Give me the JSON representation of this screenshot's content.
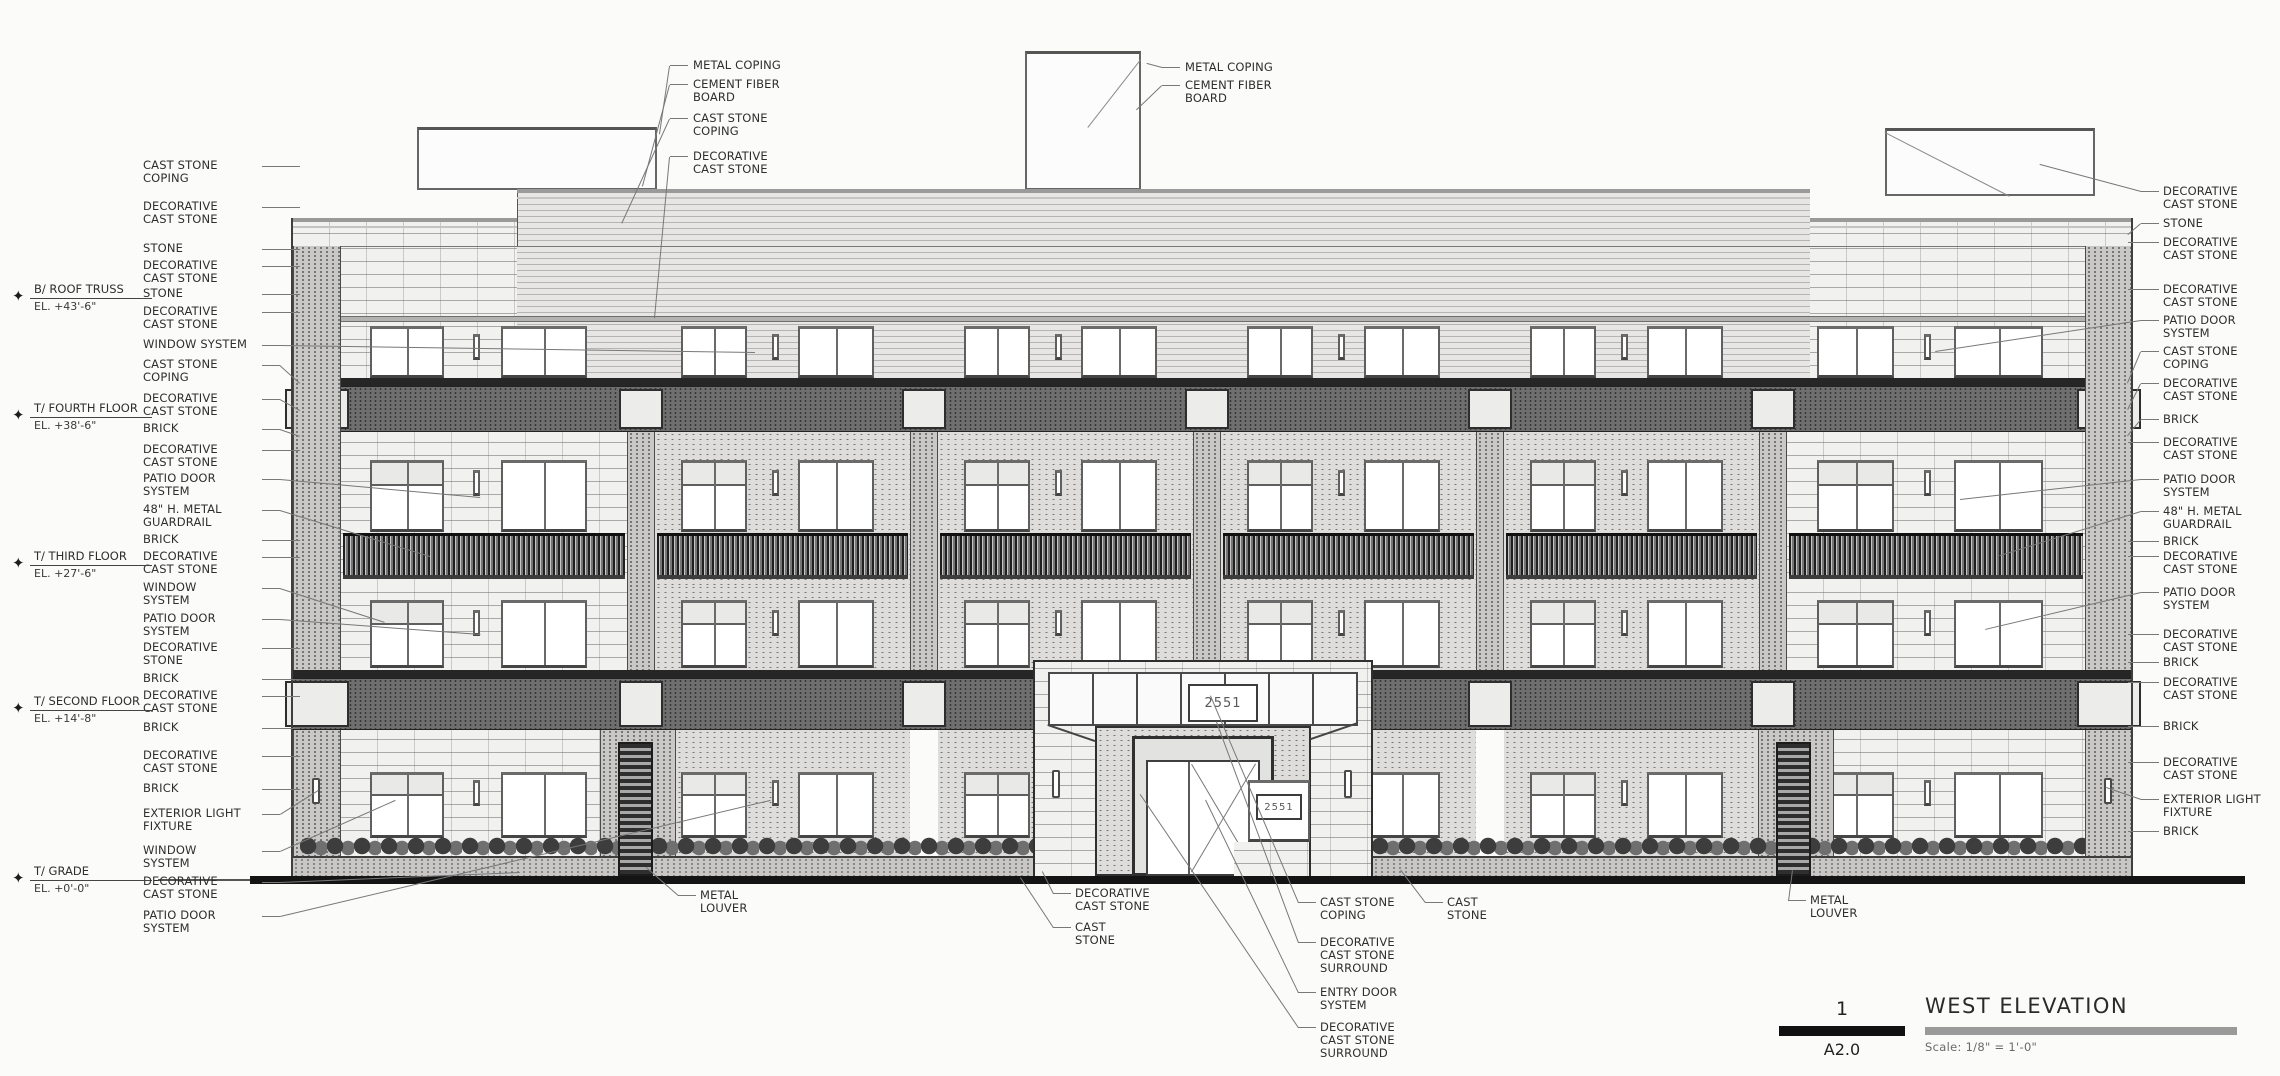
{
  "drawing": {
    "title_block": {
      "detail_number": "1",
      "sheet_number": "A2.0",
      "title": "WEST ELEVATION",
      "scale": "Scale: 1/8\" = 1'-0\""
    },
    "signs": {
      "address_plaque": "2551",
      "window_sign": "2551"
    },
    "elevation_markers": [
      {
        "y": 298,
        "name": "B/ ROOF TRUSS",
        "elevation": "EL. +43'-6\""
      },
      {
        "y": 417,
        "name": "T/ FOURTH FLOOR",
        "elevation": "EL. +38'-6\""
      },
      {
        "y": 565,
        "name": "T/ THIRD FLOOR",
        "elevation": "EL. +27'-6\""
      },
      {
        "y": 710,
        "name": "T/ SECOND FLOOR",
        "elevation": "EL. +14'-8\""
      },
      {
        "y": 880,
        "name": "T/ GRADE",
        "elevation": "EL. +0'-0\""
      }
    ],
    "callouts": {
      "left": [
        {
          "y": 166,
          "text": "CAST STONE\nCOPING"
        },
        {
          "y": 207,
          "text": "DECORATIVE\nCAST STONE"
        },
        {
          "y": 249,
          "text": "STONE"
        },
        {
          "y": 266,
          "text": "DECORATIVE\nCAST STONE"
        },
        {
          "y": 294,
          "text": "STONE"
        },
        {
          "y": 312,
          "text": "DECORATIVE\nCAST STONE"
        },
        {
          "y": 345,
          "text": "WINDOW SYSTEM",
          "tx": 755,
          "ty": 352
        },
        {
          "y": 365,
          "text": "CAST STONE\nCOPING",
          "tx": 300,
          "ty": 383
        },
        {
          "y": 399,
          "text": "DECORATIVE\nCAST STONE",
          "tx": 300,
          "ty": 410
        },
        {
          "y": 429,
          "text": "BRICK",
          "tx": 300,
          "ty": 436
        },
        {
          "y": 450,
          "text": "DECORATIVE\nCAST STONE"
        },
        {
          "y": 479,
          "text": "PATIO DOOR\nSYSTEM",
          "tx": 480,
          "ty": 497
        },
        {
          "y": 510,
          "text": "48\" H. METAL\nGUARDRAIL",
          "tx": 430,
          "ty": 556
        },
        {
          "y": 540,
          "text": "BRICK"
        },
        {
          "y": 557,
          "text": "DECORATIVE\nCAST STONE"
        },
        {
          "y": 588,
          "text": "WINDOW\nSYSTEM",
          "tx": 385,
          "ty": 622
        },
        {
          "y": 619,
          "text": "PATIO DOOR\nSYSTEM",
          "tx": 480,
          "ty": 634
        },
        {
          "y": 648,
          "text": "DECORATIVE\nSTONE"
        },
        {
          "y": 679,
          "text": "BRICK"
        },
        {
          "y": 696,
          "text": "DECORATIVE\nCAST STONE"
        },
        {
          "y": 728,
          "text": "BRICK"
        },
        {
          "y": 756,
          "text": "DECORATIVE\nCAST STONE"
        },
        {
          "y": 789,
          "text": "BRICK"
        },
        {
          "y": 814,
          "text": "EXTERIOR LIGHT\nFIXTURE",
          "tx": 318,
          "ty": 790
        },
        {
          "y": 851,
          "text": "WINDOW\nSYSTEM",
          "tx": 395,
          "ty": 800
        },
        {
          "y": 882,
          "text": "DECORATIVE\nCAST STONE",
          "tx": 520,
          "ty": 872
        },
        {
          "y": 916,
          "text": "PATIO DOOR\nSYSTEM",
          "tx": 770,
          "ty": 800
        }
      ],
      "right": [
        {
          "y": 192,
          "text": "DECORATIVE\nCAST STONE",
          "tx": 2040,
          "ty": 165
        },
        {
          "y": 224,
          "text": "STONE",
          "tx": 2128,
          "ty": 235
        },
        {
          "y": 243,
          "text": "DECORATIVE\nCAST STONE"
        },
        {
          "y": 290,
          "text": "DECORATIVE\nCAST STONE"
        },
        {
          "y": 321,
          "text": "PATIO DOOR\nSYSTEM",
          "tx": 1935,
          "ty": 352
        },
        {
          "y": 352,
          "text": "CAST STONE\nCOPING",
          "tx": 2128,
          "ty": 383
        },
        {
          "y": 384,
          "text": "DECORATIVE\nCAST STONE",
          "tx": 2128,
          "ty": 410
        },
        {
          "y": 420,
          "text": "BRICK",
          "tx": 2128,
          "ty": 436
        },
        {
          "y": 443,
          "text": "DECORATIVE\nCAST STONE"
        },
        {
          "y": 480,
          "text": "PATIO DOOR\nSYSTEM",
          "tx": 1960,
          "ty": 500
        },
        {
          "y": 512,
          "text": "48\" H. METAL\nGUARDRAIL",
          "tx": 2000,
          "ty": 556
        },
        {
          "y": 542,
          "text": "BRICK"
        },
        {
          "y": 557,
          "text": "DECORATIVE\nCAST STONE"
        },
        {
          "y": 593,
          "text": "PATIO DOOR\nSYSTEM",
          "tx": 1985,
          "ty": 630
        },
        {
          "y": 635,
          "text": "DECORATIVE\nCAST STONE"
        },
        {
          "y": 663,
          "text": "BRICK"
        },
        {
          "y": 683,
          "text": "DECORATIVE\nCAST STONE"
        },
        {
          "y": 727,
          "text": "BRICK"
        },
        {
          "y": 763,
          "text": "DECORATIVE\nCAST STONE"
        },
        {
          "y": 800,
          "text": "EXTERIOR LIGHT\nFIXTURE",
          "tx": 2106,
          "ty": 788
        },
        {
          "y": 832,
          "text": "BRICK"
        }
      ],
      "top_left": [
        {
          "y": 66,
          "text": "METAL COPING",
          "tx": 660,
          "ty": 134
        },
        {
          "y": 85,
          "text": "CEMENT FIBER\nBOARD",
          "tx": 643,
          "ty": 186
        },
        {
          "y": 119,
          "text": "CAST STONE\nCOPING",
          "tx": 622,
          "ty": 224
        },
        {
          "y": 157,
          "text": "DECORATIVE\nCAST STONE",
          "tx": 655,
          "ty": 318
        }
      ],
      "top_center": [
        {
          "y": 68,
          "text": "METAL COPING",
          "tx": 1147,
          "ty": 64
        },
        {
          "y": 86,
          "text": "CEMENT FIBER\nBOARD",
          "tx": 1137,
          "ty": 110
        }
      ],
      "bottom": [
        {
          "x": 700,
          "y": 896,
          "text": "METAL\nLOUVER",
          "tx": 646,
          "ty": 868
        },
        {
          "x": 1075,
          "y": 894,
          "text": "DECORATIVE\nCAST STONE",
          "tx": 1042,
          "ty": 872
        },
        {
          "x": 1075,
          "y": 928,
          "text": "CAST\nSTONE",
          "tx": 1020,
          "ty": 878
        },
        {
          "x": 1320,
          "y": 903,
          "text": "CAST STONE\nCOPING",
          "tx": 1210,
          "ty": 696
        },
        {
          "x": 1320,
          "y": 943,
          "text": "DECORATIVE\nCAST STONE\nSURROUND",
          "tx": 1216,
          "ty": 722
        },
        {
          "x": 1320,
          "y": 993,
          "text": "ENTRY DOOR\nSYSTEM",
          "tx": 1205,
          "ty": 800
        },
        {
          "x": 1320,
          "y": 1028,
          "text": "DECORATIVE\nCAST STONE\nSURROUND",
          "tx": 1140,
          "ty": 795
        },
        {
          "x": 1447,
          "y": 903,
          "text": "CAST\nSTONE",
          "tx": 1400,
          "ty": 870
        },
        {
          "x": 1810,
          "y": 901,
          "text": "METAL\nLOUVER",
          "tx": 1792,
          "ty": 870
        }
      ]
    }
  },
  "layout": {
    "building": {
      "x0": 293,
      "x1": 2133
    },
    "center_section": {
      "x0": 517,
      "x1": 1810,
      "top": 189
    },
    "wing_top": 218,
    "upper_field": {
      "y0": 246,
      "y1": 318
    },
    "deco_line": {
      "y0": 316,
      "y1": 322
    },
    "row4": {
      "y": 326,
      "h": 52
    },
    "band4": {
      "line_y0": 378,
      "line_y1": 386,
      "y0": 386,
      "y1": 432
    },
    "floor3": {
      "y0": 432,
      "y1": 585
    },
    "row3": {
      "y": 460,
      "h": 72
    },
    "guardrail": {
      "y": 533,
      "h": 46
    },
    "floor2": {
      "y0": 585,
      "y1": 670
    },
    "row2": {
      "y": 600,
      "h": 68
    },
    "band2": {
      "line_y0": 670,
      "line_y1": 678,
      "y0": 678,
      "y1": 730
    },
    "floor1": {
      "y0": 730,
      "y1": 856
    },
    "row1": {
      "y": 772,
      "h": 66
    },
    "base_band": {
      "y0": 856,
      "y1": 876
    },
    "grade": {
      "y": 876,
      "x0": 250,
      "x1": 2245,
      "h": 8
    },
    "bays": [
      [
        341,
        627
      ],
      [
        655,
        910
      ],
      [
        938,
        1193
      ],
      [
        1221,
        1476
      ],
      [
        1504,
        1759
      ],
      [
        1787,
        2085
      ]
    ],
    "piers": [
      [
        627,
        655
      ],
      [
        910,
        938
      ],
      [
        1193,
        1221
      ],
      [
        1476,
        1504
      ],
      [
        1759,
        1787
      ]
    ],
    "corners": [
      [
        293,
        341
      ],
      [
        2085,
        2133
      ]
    ],
    "stone_bays": [
      0,
      5
    ],
    "boxes": [
      [
        417,
        127,
        240,
        63
      ],
      [
        1025,
        51,
        116,
        139
      ],
      [
        1885,
        128,
        210,
        68
      ]
    ],
    "louver_panels": [
      [
        600,
        676
      ],
      [
        1758,
        1834
      ]
    ],
    "louvers": [
      [
        618,
        742,
        35,
        134
      ],
      [
        1776,
        742,
        35,
        134
      ]
    ],
    "shrub_strips": [
      [
        300,
        1035
      ],
      [
        1372,
        2085
      ]
    ],
    "shrub_y": 828,
    "fixtures": [
      [
        312,
        778
      ],
      [
        2104,
        778
      ]
    ],
    "portal": {
      "x0": 1033,
      "x1": 1373,
      "top": 660,
      "band_y1": 726,
      "recess_x0": 1095,
      "recess_x1": 1311,
      "door": {
        "x0": 1132,
        "x1": 1274,
        "y0": 736
      },
      "leaf_split": 1190,
      "sign": [
        1188,
        684,
        70,
        38
      ],
      "window": [
        1248,
        780,
        62,
        62
      ],
      "win_sign": [
        1256,
        794,
        46,
        26
      ],
      "slits": [
        [
          1052,
          770
        ],
        [
          1344,
          770
        ]
      ]
    }
  }
}
